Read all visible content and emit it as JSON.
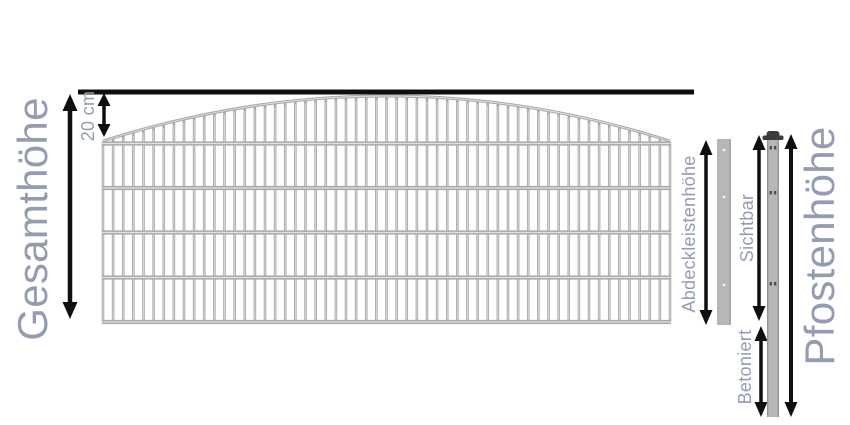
{
  "diagram": {
    "type": "fence-height-dimension-diagram",
    "labels": {
      "total_height": "Gesamthöhe",
      "arch_rise": "20 cm",
      "cover_strip_height": "Abdeckleistenhöhe",
      "visible_height": "Sichtbar",
      "concreted_depth": "Betoniert",
      "post_height": "Pfostenhöhe"
    },
    "colors": {
      "label_text": "#949cb2",
      "measurement_ink": "#0f0f0f",
      "fence_wire": "#a9a9a9",
      "wire_highlight": "#e0e0e0",
      "post_body": "#b7b7b7",
      "post_edge": "#8f8f8f",
      "post_cap": "#3b3b40"
    }
  }
}
